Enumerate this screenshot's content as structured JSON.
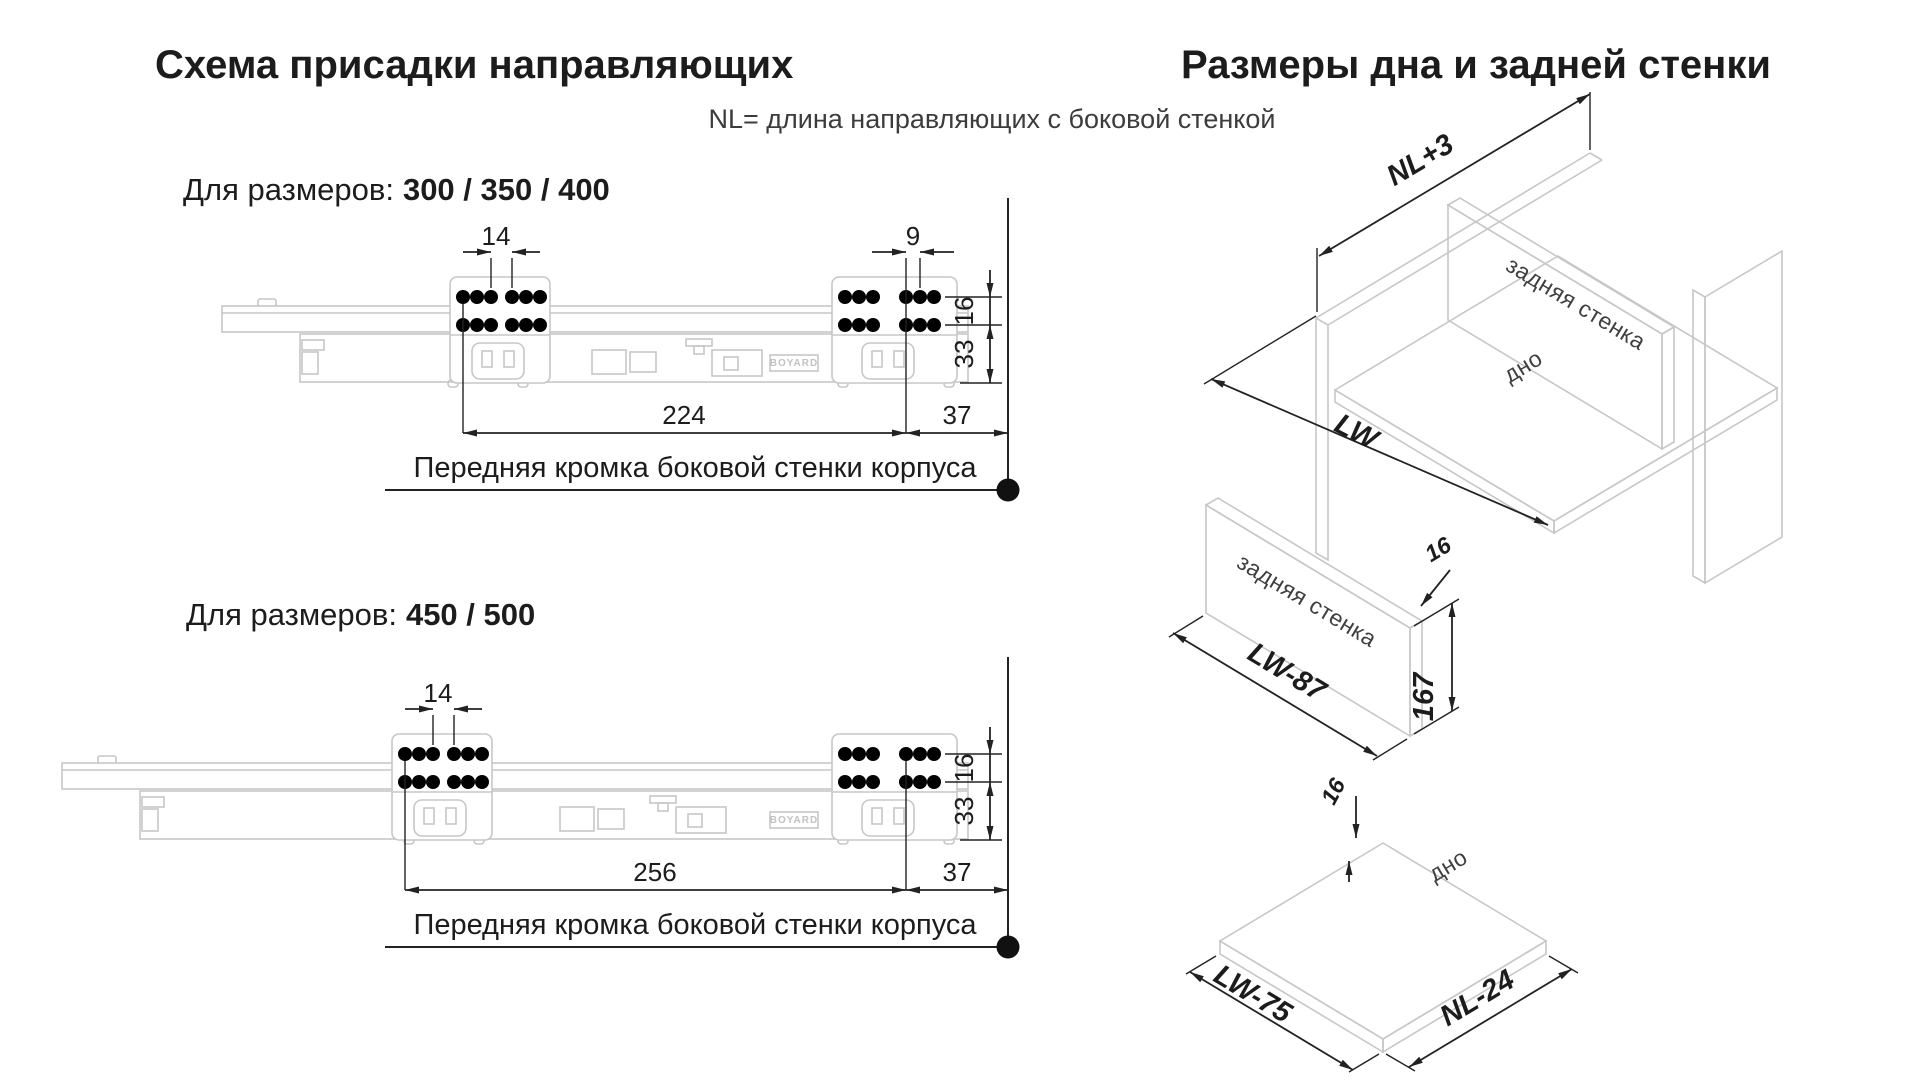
{
  "colors": {
    "accent": "#e30613"
  },
  "headings": {
    "left": "Схема присадки направляющих",
    "right": "Размеры дна и задней стенки"
  },
  "subtitle": "NL= длина направляющих с боковой стенкой",
  "diagram1": {
    "label_prefix": "Для размеров:",
    "sizes": "300 / 350 / 400",
    "dim_hole_pitch_front": "14",
    "dim_hole_pitch_rear": "9",
    "dim_row_gap": "16",
    "dim_bottom_offset": "33",
    "dim_length": "224",
    "dim_front": "37",
    "note": "Передняя кромка боковой стенки корпуса",
    "brand": "BOYARD"
  },
  "diagram2": {
    "label_prefix": "Для размеров:",
    "sizes": "450 / 500",
    "dim_hole_pitch_front": "14",
    "dim_row_gap": "16",
    "dim_bottom_offset": "33",
    "dim_length": "256",
    "dim_front": "37",
    "note": "Передняя кромка боковой стенки корпуса",
    "brand": "BOYARD"
  },
  "iso_cabinet": {
    "dim_depth": "NL+3",
    "dim_width": "LW",
    "label_back": "задняя стенка",
    "label_bottom": "дно"
  },
  "iso_back_panel": {
    "label": "задняя стенка",
    "dim_thickness": "16",
    "dim_height": "167",
    "dim_width": "LW-87"
  },
  "iso_bottom_panel": {
    "label": "дно",
    "dim_thickness": "16",
    "dim_width": "LW-75",
    "dim_depth": "NL-24"
  }
}
